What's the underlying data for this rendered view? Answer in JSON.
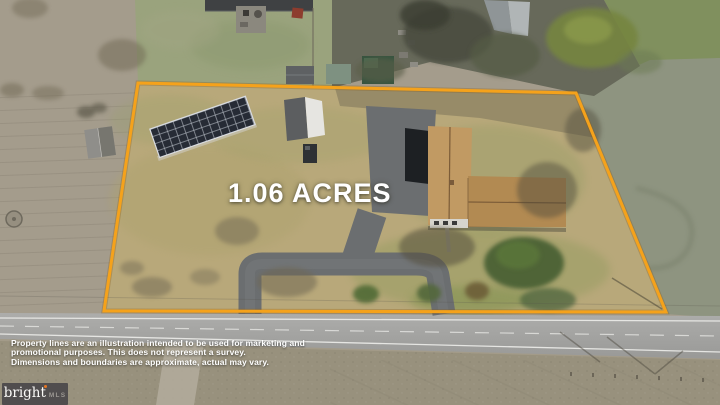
{
  "overlay": {
    "acres_label": "1.06 ACRES",
    "disclaimer": {
      "line1": "Property lines are an illustration intended to be used for marketing and",
      "line2": "promotional purposes. This does not represent a survey.",
      "line3": "Dimensions and boundaries are approximate, actual may vary."
    }
  },
  "logo": {
    "brand": "bright",
    "suffix": "MLS",
    "dot_color": "#E87722",
    "background_color": "#504D4E"
  },
  "scene": {
    "boundary_color": "#F5A21B",
    "road_line_color": "#EDEDEA",
    "features": {
      "boundary": "property-boundary-outline",
      "house": "single-story-house-tan-roof",
      "solar": "ground-mounted-solar-array",
      "driveway": "u-shaped-asphalt-driveway",
      "road": "two-lane-road",
      "shed": "white-outbuilding",
      "barn": "neighbor-shed"
    }
  }
}
